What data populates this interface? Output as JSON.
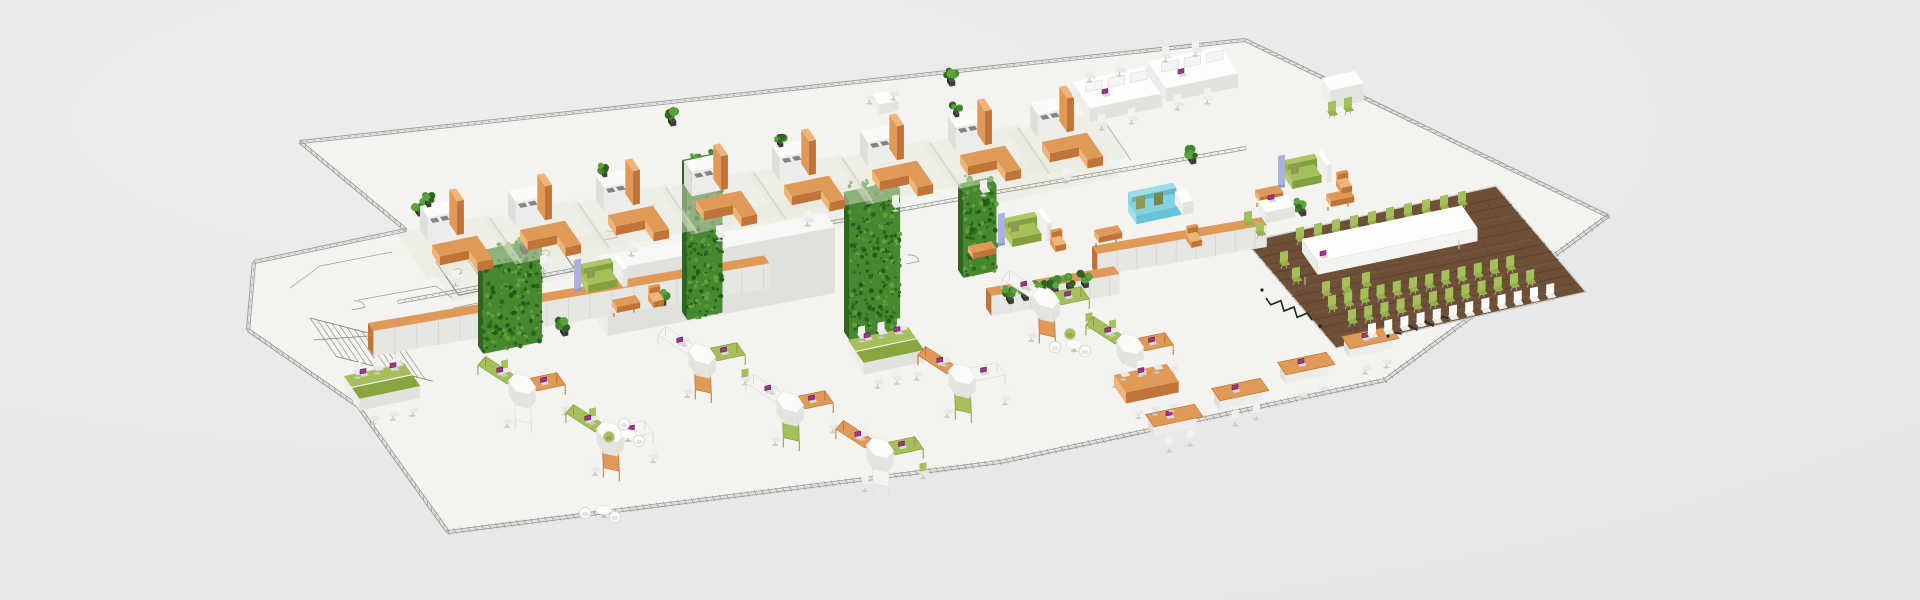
{
  "scene": {
    "description": "Isometric 3D rendering of an office floor plan on a light gray background. Left end is an unfurnished CAD line drawing with stairs, WC stalls and door arcs. The upper wing holds a row of private offices with orange L-shaped desks, white shelf cabinets with orange pillars and white task chairs, ending in white four-person bench workstations. A lounge corridor has a light-blue sofa, green sofas with lavender side panels, orange benches and armchairs. The right end is a conference / town-hall area on dark wood flooring with a long white table, green chairs, rows of green and white audience chairs and black power cables. The lower wing is an open-plan area with hexagonal white desk clusters with orange and green worktops, laptops with magenta screens, green bench desks, orange desk rows, round lounge tables with tub chairs, a long white storage wall with orange trim, tall green vertical-garden walls and potted plants."
  },
  "palette": {
    "bg": "#e9e9e9",
    "floor": "#f4f3f0",
    "floor_tint": "#e7e6da",
    "cad": "#9a9a97",
    "cad_dark": "#80807d",
    "wall_top": "#fafaf8",
    "wall_front": "#ececea",
    "wall_side": "#dededb",
    "orange": "#e09a58",
    "orange_light": "#eeb478",
    "orange_dark": "#c07437",
    "green": "#a5c05a",
    "green_dark": "#83a03c",
    "foliage": "#45882f",
    "foliage_dark": "#2d661f",
    "foliage_light": "#5ca33d",
    "wood": "#6e5039",
    "wood_dark": "#59402c",
    "wood_light": "#7d5f45",
    "blue_sofa": "#82d2e2",
    "lavender": "#a9b2e2",
    "olive": "#8e9a52",
    "white_furn": "#fbfbfa",
    "gray_furn": "#d9d9d6",
    "gray_leg": "#b0b0ad",
    "screen_magenta": "#a8308c",
    "cable": "#222220",
    "pot": "#3a3a37"
  },
  "counts": {
    "private_office_desks": 8,
    "bench_workstation_seats": 8,
    "hex_clusters": 8,
    "hex_desk_wings": 24,
    "green_bench_desks": 2,
    "orange_desk_rows": 4,
    "sofas_green": 3,
    "sofa_blue": 1,
    "lounge_sets": 3,
    "garden_walls": 4,
    "conference_table_chairs": 15,
    "audience_chair_rows": 3,
    "audience_chairs_per_row": 12,
    "potted_plants": 14,
    "laptops": 30
  },
  "layout": {
    "outline": [
      [
        300,
        142
      ],
      [
        1245,
        40
      ],
      [
        1608,
        216
      ],
      [
        1385,
        380
      ],
      [
        1000,
        462
      ],
      [
        448,
        532
      ],
      [
        358,
        406
      ],
      [
        248,
        330
      ],
      [
        254,
        262
      ],
      [
        406,
        230
      ]
    ],
    "wood": [
      [
        1246,
        242
      ],
      [
        1496,
        186
      ],
      [
        1586,
        292
      ],
      [
        1336,
        348
      ]
    ],
    "inner_tracks": [
      [
        398,
        302,
        1008,
        190
      ],
      [
        1008,
        190,
        1246,
        148
      ]
    ],
    "corridor_tints": [
      [
        430,
        268,
        190,
        38
      ],
      [
        700,
        218,
        170,
        38
      ],
      [
        952,
        176,
        150,
        36
      ]
    ],
    "stairs": {
      "x": 310,
      "y": 318,
      "n": 13
    },
    "wc_block": {
      "x": 436,
      "y": 262,
      "w": 120,
      "d": 38,
      "stalls": 4
    },
    "doors": [
      [
        470,
        320
      ],
      [
        548,
        304
      ],
      [
        352,
        310
      ],
      [
        640,
        294
      ],
      [
        906,
        264
      ],
      [
        604,
        240
      ]
    ],
    "monolith": {
      "x": 598,
      "y": 322,
      "w": 232,
      "d": 16,
      "h": 66
    },
    "storage_walls": [
      {
        "x": 368,
        "y": 348,
        "w": 402,
        "d": 9,
        "h": 25,
        "seam": 22
      },
      {
        "x": 1092,
        "y": 268,
        "w": 172,
        "d": 9,
        "h": 22,
        "seam": 20
      },
      {
        "x": 986,
        "y": 308,
        "w": 130,
        "d": 9,
        "h": 20,
        "seam": 20
      }
    ],
    "garden_walls": [
      [
        478,
        346,
        60,
        95
      ],
      [
        682,
        312,
        36,
        152
      ],
      [
        844,
        332,
        52,
        140
      ],
      [
        958,
        270,
        34,
        86
      ]
    ],
    "plant_row": {
      "x": 1006,
      "y": 300,
      "n": 6,
      "dx": 15,
      "dy": -3.2
    },
    "plants": [
      [
        415,
        212
      ],
      [
        668,
        122
      ],
      [
        947,
        82
      ],
      [
        1188,
        160
      ],
      [
        1298,
        212
      ],
      [
        560,
        332
      ],
      [
        658,
        302
      ],
      [
        520,
        250
      ]
    ],
    "desk_modules": [
      [
        420,
        230
      ],
      [
        508,
        215
      ],
      [
        596,
        200
      ],
      [
        684,
        185
      ],
      [
        772,
        170
      ],
      [
        860,
        155
      ],
      [
        948,
        140
      ],
      [
        1030,
        127
      ]
    ],
    "bench_pods": [
      [
        1072,
        96
      ],
      [
        1148,
        76
      ]
    ],
    "sofas_green": [
      [
        578,
        282
      ],
      [
        1002,
        236
      ],
      [
        1282,
        178
      ]
    ],
    "sofa_blue": [
      1128,
      212
    ],
    "benches": [
      [
        612,
        306
      ],
      [
        968,
        252
      ],
      [
        1255,
        196
      ],
      [
        1326,
        200
      ],
      [
        1094,
        236
      ]
    ],
    "armchairs": [
      [
        648,
        300
      ],
      [
        1050,
        244
      ],
      [
        1336,
        186
      ],
      [
        1186,
        240
      ]
    ],
    "meet_white": [
      872,
      104
    ],
    "green_pod": [
      1322,
      96
    ],
    "hex_clusters": [
      {
        "x": 522,
        "y": 398,
        "cols": [
          "orange",
          "white",
          "green"
        ]
      },
      {
        "x": 610,
        "y": 446,
        "cols": [
          "white",
          "orange",
          "green"
        ]
      },
      {
        "x": 702,
        "y": 368,
        "cols": [
          "green",
          "orange",
          "white"
        ]
      },
      {
        "x": 790,
        "y": 416,
        "cols": [
          "orange",
          "green",
          "white"
        ]
      },
      {
        "x": 880,
        "y": 462,
        "cols": [
          "green",
          "white",
          "orange"
        ]
      },
      {
        "x": 962,
        "y": 388,
        "cols": [
          "white",
          "green",
          "orange"
        ]
      },
      {
        "x": 1046,
        "y": 312,
        "cols": [
          "green",
          "orange",
          "white"
        ]
      },
      {
        "x": 1130,
        "y": 358,
        "cols": [
          "orange",
          "white",
          "green"
        ]
      }
    ],
    "green_benches": [
      [
        344,
        388
      ],
      [
        848,
        352
      ]
    ],
    "orange_rows": [
      [
        1148,
        428
      ],
      [
        1214,
        402
      ],
      [
        1280,
        376
      ],
      [
        1344,
        350
      ]
    ],
    "meeting_table": [
      1114,
      386
    ],
    "lounges": [
      {
        "x": 618,
        "y": 432,
        "tubs": [
          "green",
          "white",
          "white"
        ]
      },
      {
        "x": 594,
        "y": 508,
        "tubs": [
          "white",
          "white"
        ]
      },
      {
        "x": 1064,
        "y": 342,
        "tubs": [
          "white",
          "white",
          "green"
        ]
      }
    ],
    "conference": {
      "table": {
        "x": 1302,
        "y": 252,
        "len": 164,
        "w": 26
      },
      "laptop": [
        1320,
        256
      ],
      "chairs_far": {
        "x": 1296,
        "y": 238,
        "n": 10,
        "dx": 18.0,
        "dy": -4.0
      },
      "chairs_end": [
        [
          1280,
          262
        ],
        [
          1292,
          278
        ]
      ],
      "chairs_near": [
        [
          1322,
          292
        ],
        [
          1342,
          288
        ],
        [
          1362,
          283
        ]
      ],
      "small_desk": {
        "x": 1258,
        "y": 212
      },
      "small_desk_chairs": [
        [
          1244,
          222
        ],
        [
          1256,
          232
        ]
      ],
      "audience": [
        {
          "color": "green",
          "x": 1328,
          "y": 306,
          "n": 12,
          "dx": 16.2,
          "dy": -3.6
        },
        {
          "color": "green",
          "x": 1348,
          "y": 320,
          "n": 12,
          "dx": 16.2,
          "dy": -3.6
        },
        {
          "color": "white",
          "x": 1368,
          "y": 334,
          "n": 12,
          "dx": 16.2,
          "dy": -3.6
        }
      ],
      "cables": [
        [
          1266,
          298,
          1312,
          320
        ],
        [
          1392,
          332,
          1448,
          318
        ]
      ],
      "plugs": [
        [
          1262,
          290
        ],
        [
          1320,
          326
        ],
        [
          1388,
          336
        ]
      ]
    }
  }
}
